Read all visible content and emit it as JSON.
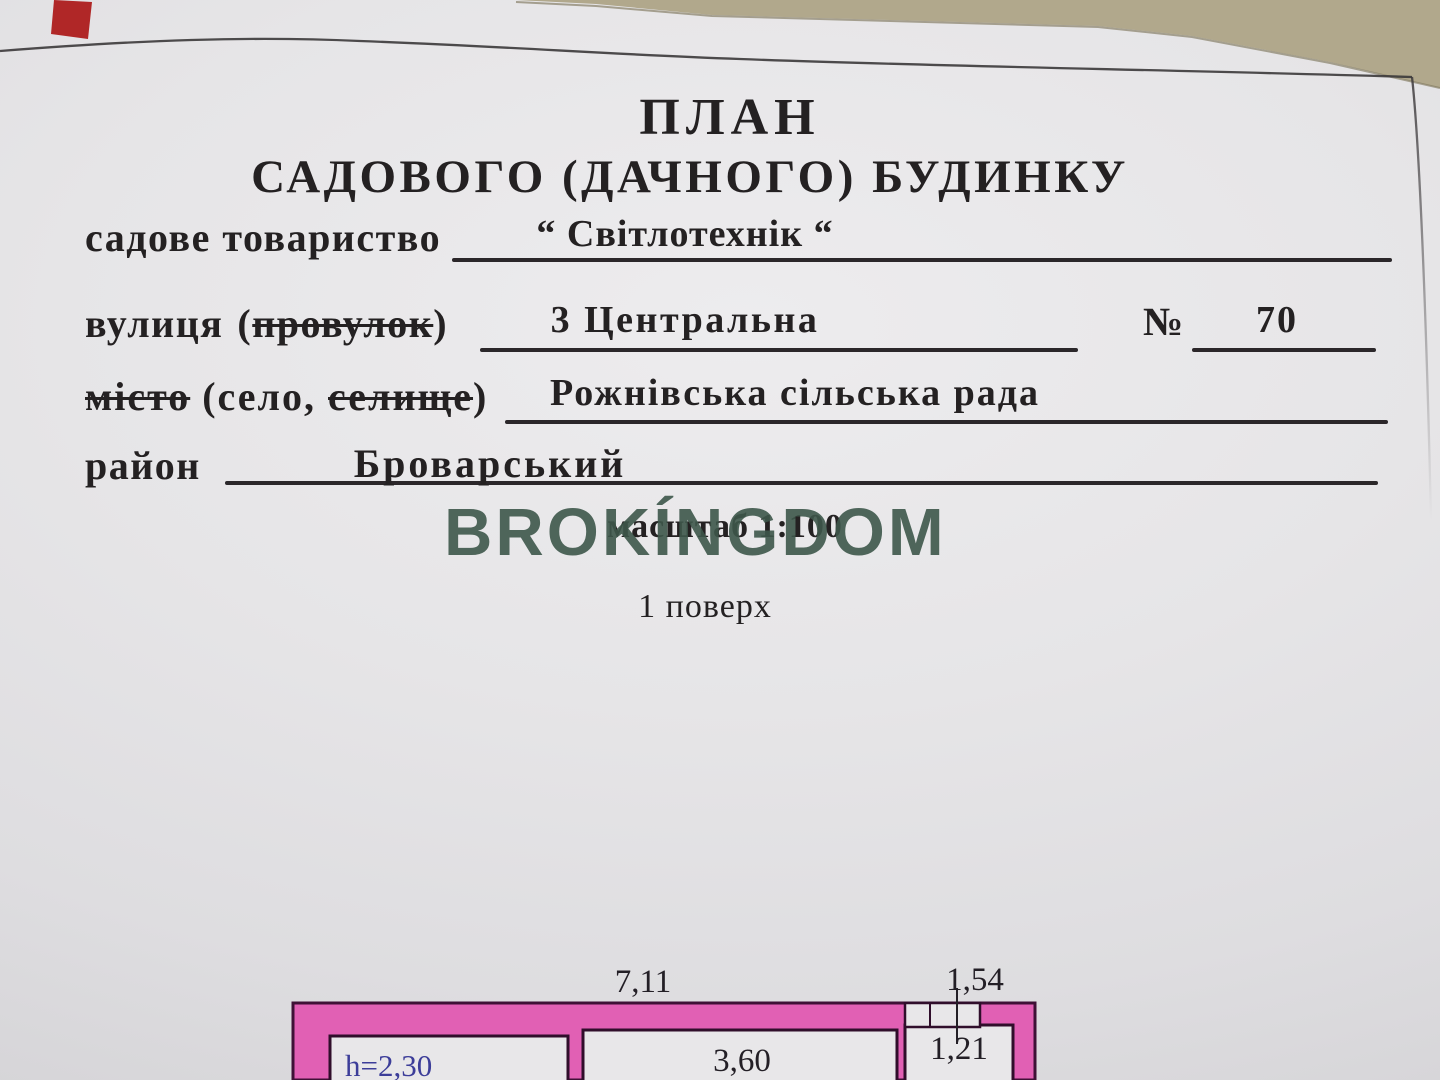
{
  "document": {
    "title_line1": "ПЛАН",
    "title_line2": "САДОВОГО (ДАЧНОГО) БУДИНКУ",
    "society": {
      "label": "садове товариство",
      "value": "“ Світлотехнік “"
    },
    "street": {
      "label": "вулиця",
      "paren_open": "(",
      "struck_word": "провулок",
      "paren_close": ")",
      "value": "3 Центральна",
      "number_sign": "№",
      "number_value": "70"
    },
    "city": {
      "struck_word1": "місто",
      "middle": "(село,",
      "struck_word2": "селище",
      "paren_close": ")",
      "value": "Рожнівська сільська рада"
    },
    "district": {
      "label": "район",
      "value": "Броварський"
    },
    "scale_note": "масштаб 1:100",
    "floor_note": "1 поверх",
    "watermark": "BROKÍNGDOM"
  },
  "plan": {
    "dim_overall_width": "7,11",
    "dim_entry_width": "1,54",
    "dim_entry_room": "1,21",
    "dim_middle_room": "3,60",
    "dim_ceiling_height": "h=2,30"
  },
  "colors": {
    "paper": "#e6e5e7",
    "desk_background": "#b1a88c",
    "ink": "#242122",
    "watermark_green": "#3e574b",
    "wall_pink": "#e160b4",
    "wall_outline": "#3f1136",
    "height_label_blue": "#3c3d99",
    "red_marker": "#b02727"
  }
}
